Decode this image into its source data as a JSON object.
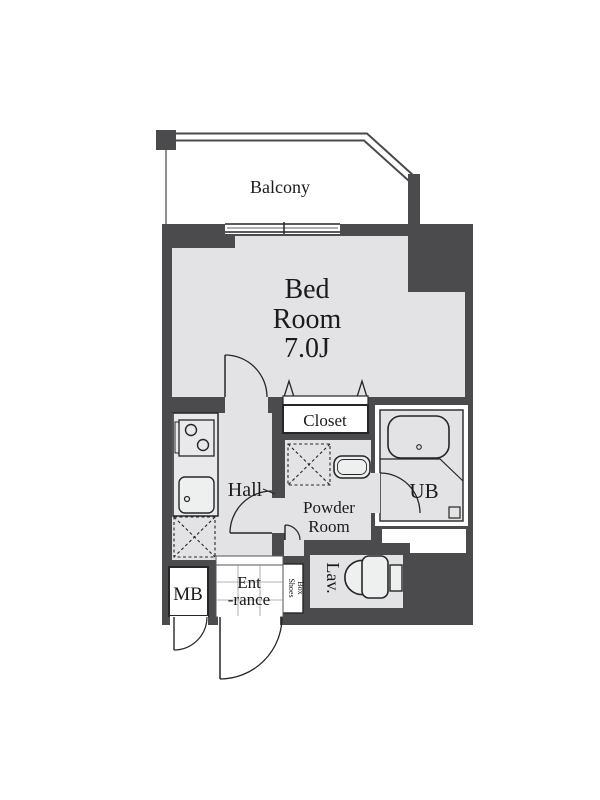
{
  "title": "Apartment floor plan",
  "colors": {
    "wall": "#4b4b4d",
    "floor": "#e3e3e5",
    "fixture_fill": "#eef0f0",
    "line": "#262626",
    "background": "#ffffff"
  },
  "rooms": {
    "balcony": {
      "label": "Balcony"
    },
    "bedroom": {
      "label_line1": "Bed",
      "label_line2": "Room",
      "size": "7.0J"
    },
    "closet": {
      "label": "Closet"
    },
    "hall": {
      "label": "Hall"
    },
    "powder_room": {
      "label_line1": "Powder",
      "label_line2": "Room"
    },
    "unit_bath": {
      "label": "UB"
    },
    "meter_box": {
      "label": "MB"
    },
    "entrance": {
      "label_line1": "Ent",
      "label_line2": "-rance"
    },
    "shoes_box": {
      "label_line1": "Shoes",
      "label_line2": "Box"
    },
    "lavatory": {
      "label": "Lav."
    }
  }
}
